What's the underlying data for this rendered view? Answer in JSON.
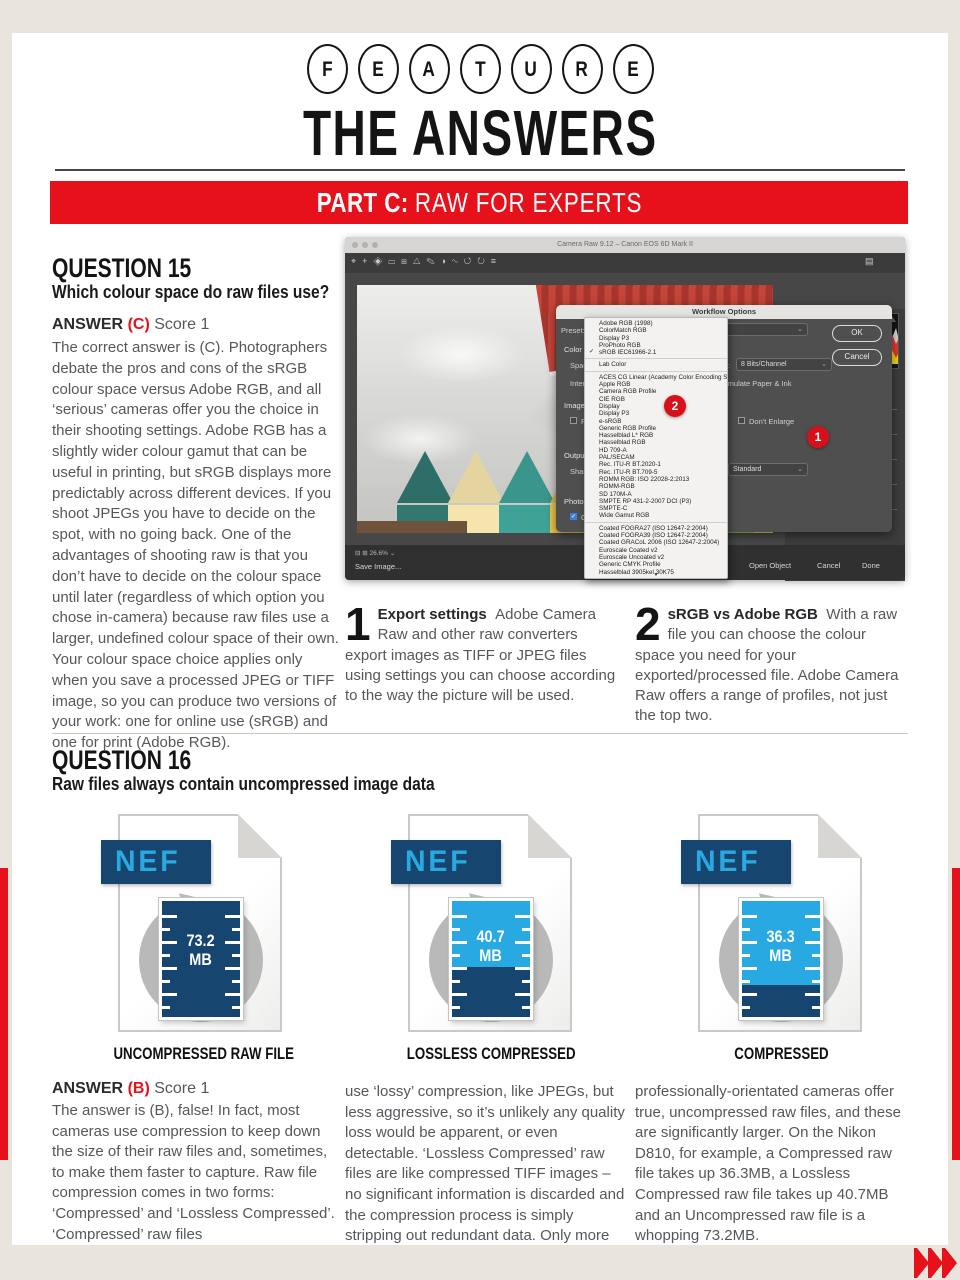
{
  "colors": {
    "red": "#e6111b",
    "navy": "#16466f",
    "blue": "#29a9e1"
  },
  "header": {
    "feature_letters": [
      "F",
      "E",
      "A",
      "T",
      "U",
      "R",
      "E"
    ],
    "title": "THE ANSWERS",
    "banner_part": "PART C:",
    "banner_rest": "RAW FOR EXPERTS"
  },
  "q15": {
    "heading": "QUESTION 15",
    "subheading": "Which colour space do raw files use?",
    "answer_label": "ANSWER",
    "answer_letter": "(C)",
    "score": "Score 1",
    "body": "The correct answer is (C). Photographers debate the pros and cons of the sRGB colour space versus Adobe RGB, and all ‘serious’ cameras offer you the choice in their shooting settings. Adobe RGB has a slightly wider colour gamut that can be useful in printing, but sRGB displays more predictably across different devices. If you shoot JPEGs you have to decide on the spot, with no going back. One of the advantages of shooting raw is that you don’t have to decide on the colour space until later (regardless of which option you chose in-camera) because raw files use a larger, undefined colour space of their own. Your colour space choice applies only when you save a processed JPEG or TIFF image, so you can produce two versions of your work: one for online use (sRGB) and one for print (Adobe RGB)."
  },
  "captions": [
    {
      "num": "1",
      "lead": "Export settings",
      "text": "Adobe Camera Raw and other raw converters export images as TIFF or JPEG files using settings you can choose according to the way the picture will be used."
    },
    {
      "num": "2",
      "lead": "sRGB vs Adobe RGB",
      "text": "With a raw file you can choose the colour space you need for your exported/processed file. Adobe Camera Raw offers a range of profiles, not just the top two."
    }
  ],
  "acr": {
    "window_title": "Camera Raw 9.12 – Canon EOS 6D Mark II",
    "toolbar_icons": [
      "⌖",
      "+",
      "◈",
      "▭",
      "⊞",
      "△",
      "✎",
      "◑",
      "∿",
      "↺",
      "↻",
      "≡"
    ],
    "panel_toggle_icon": "▤",
    "dialog": {
      "title": "Workflow Options",
      "preset_label": "Preset:",
      "sections": [
        "Color Space",
        "Image Sizing",
        "Output Sharpening",
        "Photoshop"
      ],
      "space_label": "Space:",
      "depth_label": "Depth:",
      "depth_value": "8 Bits/Channel",
      "intent_label": "Intent:",
      "simulate_label": "Simulate Paper & Ink",
      "resize_label": "Resize to Fit:",
      "dont_enlarge_label": "Don't Enlarge",
      "sharpen_label": "Sharpen For:",
      "amount_value": "Standard",
      "photoshop_label": "Open in Photoshop as Smart Objects",
      "ok": "OK",
      "cancel": "Cancel"
    },
    "menu": {
      "checked": "sRGB IEC61966-2.1",
      "groups": [
        [
          "Adobe RGB (1998)",
          "ColorMatch RGB",
          "Display P3",
          "ProPhoto RGB",
          "sRGB IEC61966-2.1"
        ],
        [
          "Lab Color"
        ],
        [
          "ACES CG Linear (Academy Color Encoding System AP1)",
          "Apple RGB",
          "Camera RGB Profile",
          "CIE RGB",
          "Display",
          "Display P3",
          "e-sRGB",
          "Generic RGB Profile",
          "Hasselblad L* RGB",
          "Hasselblad RGB",
          "HD 709-A",
          "PAL/SECAM",
          "Rec. ITU-R BT.2020-1",
          "Rec. ITU-R BT.709-5",
          "ROMM RGB: ISO 22028-2:2013",
          "ROMM-RGB",
          "SD 170M-A",
          "SMPTE RP 431-2-2007 DCI (P3)",
          "SMPTE-C",
          "Wide Gamut RGB"
        ],
        [
          "Coated FOGRA27 (ISO 12647-2:2004)",
          "Coated FOGRA39 (ISO 12647-2:2004)",
          "Coated GRACoL 2006 (ISO 12647-2:2004)",
          "Euroscale Coated v2",
          "Euroscale Uncoated v2",
          "Generic CMYK Profile",
          "Hasselblad 3905kel 30K75"
        ]
      ]
    },
    "right_panel": {
      "saturation": "Saturation"
    },
    "bottom": {
      "zoom": "26.6%",
      "save": "Save Image...",
      "filename": "6787_IMG_5578.CR2",
      "open_object": "Open Object",
      "cancel": "Cancel",
      "done": "Done"
    },
    "markers": [
      {
        "label": "1"
      },
      {
        "label": "2"
      }
    ],
    "photo": {
      "hut_colors": [
        "#2e6e68",
        "#e3d4a0",
        "#3a968c",
        "#ddb642",
        "#5aa7d6",
        "#e2899e",
        "#8cb94f",
        "#d9c23f"
      ]
    }
  },
  "q16": {
    "heading": "QUESTION 16",
    "subheading": "Raw files always contain uncompressed image data",
    "answer_label": "ANSWER",
    "answer_letter": "(B)",
    "score": "Score 1",
    "files": [
      {
        "type_label": "NEF",
        "size": "73.2",
        "unit": "MB",
        "blue_percent": 0,
        "caption": "UNCOMPRESSED RAW FILE"
      },
      {
        "type_label": "NEF",
        "size": "40.7",
        "unit": "MB",
        "blue_percent": 57,
        "caption": "LOSSLESS COMPRESSED"
      },
      {
        "type_label": "NEF",
        "size": "36.3",
        "unit": "MB",
        "blue_percent": 72,
        "caption": "COMPRESSED"
      }
    ],
    "columns": [
      "The answer is (B), false! In fact, most cameras use compression to keep down the size of their raw files and, sometimes, to make them faster to capture. Raw file compression comes in two forms: ‘Compressed’ and ‘Lossless Compressed’. ‘Compressed’ raw files",
      "use ‘lossy’ compression, like JPEGs, but less aggressive, so it’s unlikely any quality loss would be apparent, or even detectable. ‘Lossless Compressed’ raw files are like compressed TIFF images – no significant information is discarded and the compression process is simply stripping out redundant data. Only more",
      "professionally-orientated cameras offer true, uncompressed raw files, and these are significantly larger. On the Nikon D810, for example, a Compressed raw file takes up 36.3MB, a Lossless Compressed raw file takes up 40.7MB and an Uncompressed raw file is a whopping 73.2MB."
    ]
  }
}
